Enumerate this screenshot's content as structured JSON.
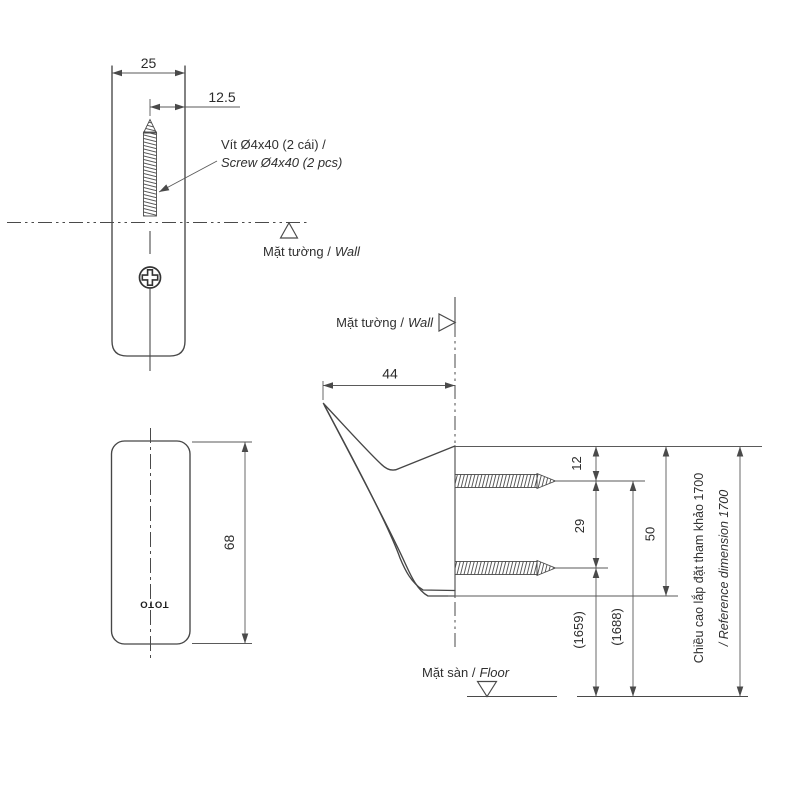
{
  "front_view": {
    "dim_width": "25",
    "dim_offset": "12.5",
    "screw_note_vi": "Vít Ø4x40 (2 cái) /",
    "screw_note_en": "Screw Ø4x40 (2 pcs)",
    "wall_label_vi": "Mặt tường /",
    "wall_label_en": "Wall"
  },
  "side_view": {
    "dim_height": "68",
    "logo": "TOTO"
  },
  "profile_view": {
    "wall_label_vi": "Mặt tường /",
    "wall_label_en": "Wall",
    "floor_label_vi": "Mặt sàn /",
    "floor_label_en": "Floor",
    "dim_depth": "44",
    "dim_top_to_screw1": "12",
    "dim_screw1_to_screw2": "29",
    "dim_body_height": "50",
    "dim_screw2_height": "(1659)",
    "dim_screw1_height": "(1688)",
    "ref_height_vi": "Chiều cao lắp đặt tham khảo 1700",
    "ref_height_en": "/ Reference dimension 1700"
  }
}
